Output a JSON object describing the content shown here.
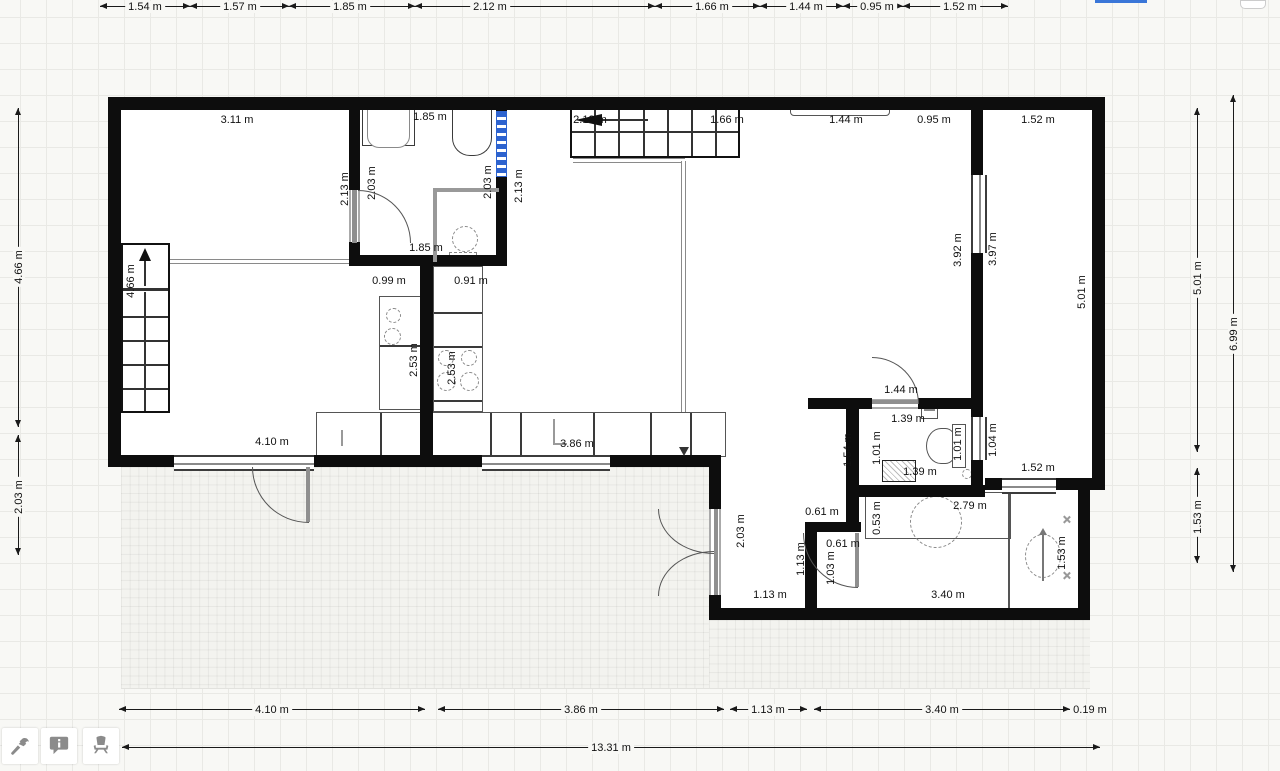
{
  "app": {
    "type": "floor-plan-editor",
    "selection_color": "#2d63cf"
  },
  "toolbar": {
    "buttons": [
      {
        "name": "build-tool",
        "icon": "hammer-icon"
      },
      {
        "name": "annotation-tool",
        "icon": "info-bubble-icon"
      },
      {
        "name": "furniture-tool",
        "icon": "chair-icon"
      }
    ]
  },
  "dimensions": [
    {
      "o": "h",
      "y": 6,
      "from": 100,
      "to": 190,
      "at": 145,
      "label": "1.54 m"
    },
    {
      "o": "h",
      "y": 6,
      "from": 190,
      "to": 289,
      "at": 240,
      "label": "1.57 m"
    },
    {
      "o": "h",
      "y": 6,
      "from": 289,
      "to": 415,
      "at": 350,
      "label": "1.85 m"
    },
    {
      "o": "h",
      "y": 6,
      "from": 415,
      "to": 655,
      "at": 490,
      "label": "2.12 m"
    },
    {
      "o": "h",
      "y": 6,
      "from": 655,
      "to": 760,
      "at": 712,
      "label": "1.66 m"
    },
    {
      "o": "h",
      "y": 6,
      "from": 760,
      "to": 843,
      "at": 806,
      "label": "1.44 m"
    },
    {
      "o": "h",
      "y": 6,
      "from": 843,
      "to": 903,
      "at": 877,
      "label": "0.95 m"
    },
    {
      "o": "h",
      "y": 6,
      "from": 903,
      "to": 1008,
      "at": 960,
      "label": "1.52 m"
    },
    {
      "o": "v",
      "x": 18,
      "from": 108,
      "to": 427,
      "at": 267,
      "label": "4.66 m"
    },
    {
      "o": "v",
      "x": 18,
      "from": 435,
      "to": 555,
      "at": 497,
      "label": "2.03 m"
    },
    {
      "o": "v",
      "x": 1197,
      "from": 108,
      "to": 452,
      "at": 278,
      "label": "5.01 m"
    },
    {
      "o": "v",
      "x": 1197,
      "from": 468,
      "to": 563,
      "at": 517,
      "label": "1.53 m"
    },
    {
      "o": "v",
      "x": 1233,
      "from": 95,
      "to": 572,
      "at": 334,
      "label": "6.99 m"
    },
    {
      "o": "h",
      "y": 709,
      "from": 119,
      "to": 425,
      "at": 272,
      "label": "4.10 m"
    },
    {
      "o": "h",
      "y": 709,
      "from": 438,
      "to": 724,
      "at": 581,
      "label": "3.86 m"
    },
    {
      "o": "h",
      "y": 709,
      "from": 730,
      "to": 807,
      "at": 768,
      "label": "1.13 m"
    },
    {
      "o": "h",
      "y": 709,
      "from": 814,
      "to": 1070,
      "at": 942,
      "label": "3.40 m"
    },
    {
      "o": "h",
      "y": 709,
      "from": 1072,
      "to": 1105,
      "at": 1090,
      "label": "0.19 m"
    },
    {
      "o": "h",
      "y": 747,
      "from": 122,
      "to": 1100,
      "at": 611,
      "label": "13.31 m"
    }
  ],
  "plan_labels": [
    {
      "text": "3.11 m",
      "x": 237,
      "y": 120,
      "rot": false
    },
    {
      "text": "1.85 m",
      "x": 430,
      "y": 117,
      "rot": false
    },
    {
      "text": "2.12 m",
      "x": 590,
      "y": 120,
      "rot": false
    },
    {
      "text": "1.66 m",
      "x": 727,
      "y": 120,
      "rot": false
    },
    {
      "text": "1.44 m",
      "x": 846,
      "y": 120,
      "rot": false
    },
    {
      "text": "0.95 m",
      "x": 934,
      "y": 120,
      "rot": false
    },
    {
      "text": "1.52 m",
      "x": 1038,
      "y": 120,
      "rot": false
    },
    {
      "text": "1.85 m",
      "x": 426,
      "y": 248,
      "rot": false
    },
    {
      "text": "0.99 m",
      "x": 389,
      "y": 281,
      "rot": false
    },
    {
      "text": "0.91 m",
      "x": 471,
      "y": 281,
      "rot": false
    },
    {
      "text": "4.10 m",
      "x": 272,
      "y": 442,
      "rot": false
    },
    {
      "text": "3.86 m",
      "x": 577,
      "y": 444,
      "rot": false
    },
    {
      "text": "1.44 m",
      "x": 901,
      "y": 390,
      "rot": false
    },
    {
      "text": "1.39 m",
      "x": 908,
      "y": 419,
      "rot": false
    },
    {
      "text": "1.39 m",
      "x": 920,
      "y": 472,
      "rot": false
    },
    {
      "text": "1.52 m",
      "x": 1038,
      "y": 468,
      "rot": false
    },
    {
      "text": "2.79 m",
      "x": 970,
      "y": 506,
      "rot": false
    },
    {
      "text": "0.61 m",
      "x": 822,
      "y": 512,
      "rot": false
    },
    {
      "text": "0.61 m",
      "x": 843,
      "y": 544,
      "rot": false
    },
    {
      "text": "1.13 m",
      "x": 770,
      "y": 595,
      "rot": false
    },
    {
      "text": "3.40 m",
      "x": 948,
      "y": 595,
      "rot": false
    },
    {
      "text": "2.13 m",
      "x": 345,
      "y": 189,
      "rot": true
    },
    {
      "text": "2.03 m",
      "x": 372,
      "y": 183,
      "rot": true
    },
    {
      "text": "2.03 m",
      "x": 488,
      "y": 182,
      "rot": true
    },
    {
      "text": "2.13 m",
      "x": 519,
      "y": 186,
      "rot": true
    },
    {
      "text": "4.66 m",
      "x": 131,
      "y": 281,
      "rot": true
    },
    {
      "text": "2.53 m",
      "x": 414,
      "y": 360,
      "rot": true
    },
    {
      "text": "2.53 m",
      "x": 452,
      "y": 368,
      "rot": true
    },
    {
      "text": "3.92 m",
      "x": 958,
      "y": 250,
      "rot": true
    },
    {
      "text": "3.97 m",
      "x": 993,
      "y": 249,
      "rot": true
    },
    {
      "text": "5.01 m",
      "x": 1082,
      "y": 292,
      "rot": true
    },
    {
      "text": "1.54 m",
      "x": 848,
      "y": 450,
      "rot": true
    },
    {
      "text": "1.01 m",
      "x": 877,
      "y": 448,
      "rot": true
    },
    {
      "text": "1.01 m",
      "x": 958,
      "y": 444,
      "rot": true
    },
    {
      "text": "1.04 m",
      "x": 993,
      "y": 440,
      "rot": true
    },
    {
      "text": "0.53 m",
      "x": 877,
      "y": 518,
      "rot": true
    },
    {
      "text": "2.03 m",
      "x": 741,
      "y": 531,
      "rot": true
    },
    {
      "text": "1.13 m",
      "x": 801,
      "y": 559,
      "rot": true
    },
    {
      "text": "1.03 m",
      "x": 831,
      "y": 568,
      "rot": true
    },
    {
      "text": "1.53 m",
      "x": 1062,
      "y": 553,
      "rot": true
    }
  ]
}
